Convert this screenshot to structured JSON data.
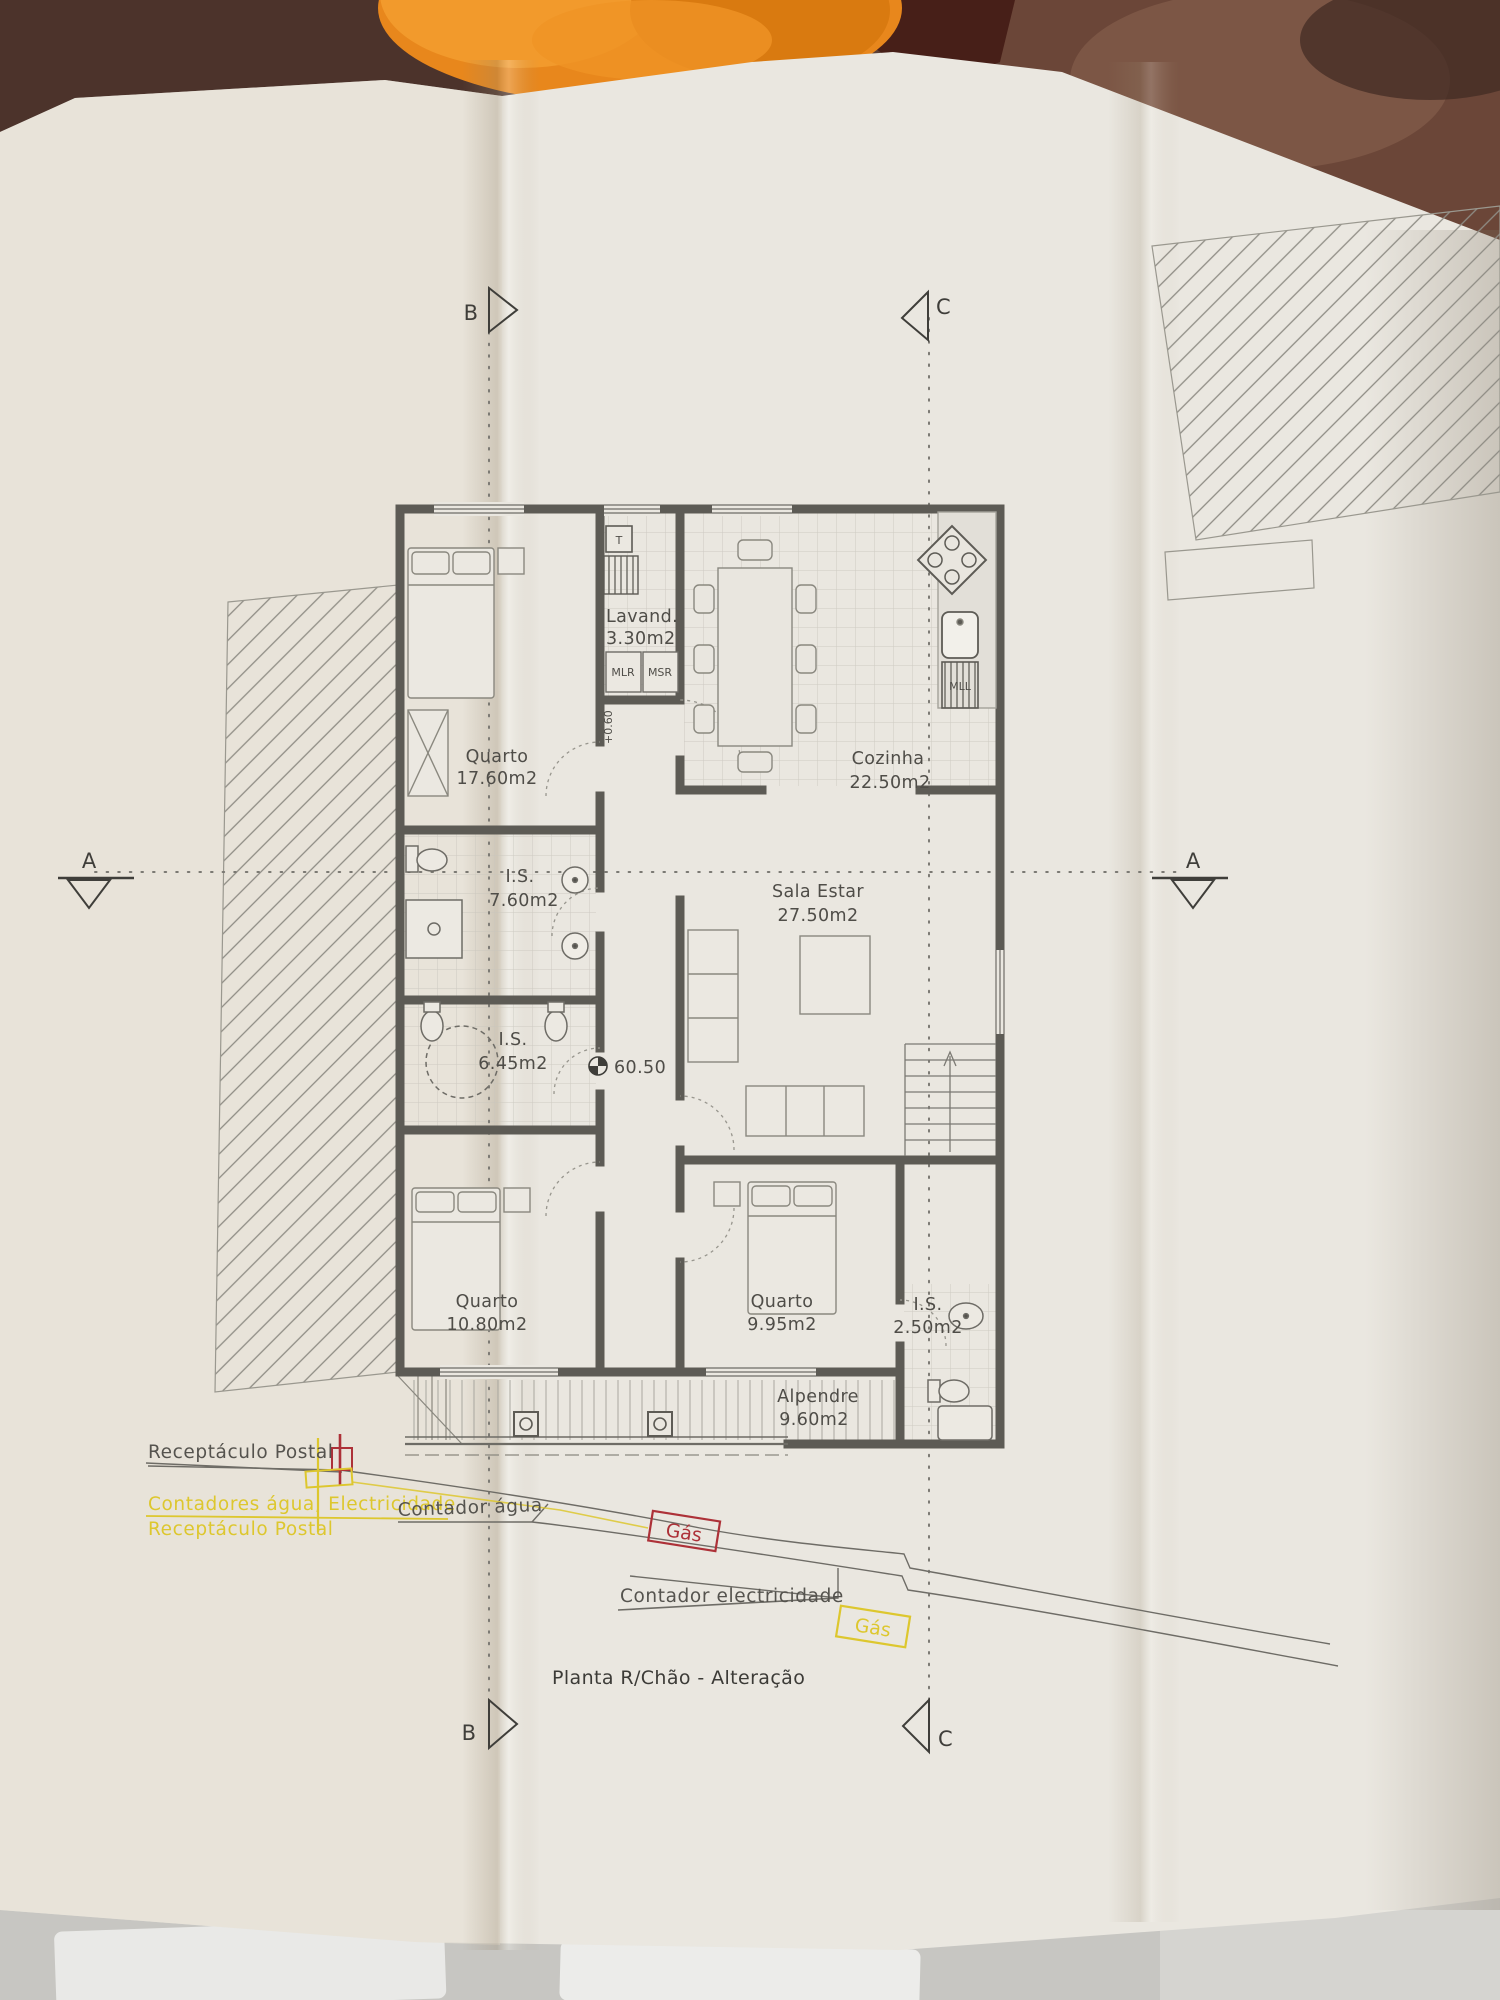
{
  "title": "Planta R/Chão - Alteração",
  "section_markers": {
    "a": "A",
    "b": "B",
    "c": "C"
  },
  "rooms": [
    {
      "name": "Quarto",
      "area": "17.60m2"
    },
    {
      "name": "Lavand.",
      "area": "3.30m2"
    },
    {
      "name": "Cozinha",
      "area": "22.50m2"
    },
    {
      "name": "I.S.",
      "area": "7.60m2"
    },
    {
      "name": "Sala  Estar",
      "area": "27.50m2"
    },
    {
      "name": "I.S.",
      "area": "6.45m2"
    },
    {
      "name": "Quarto",
      "area": "10.80m2"
    },
    {
      "name": "Quarto",
      "area": "9.95m2"
    },
    {
      "name": "I.S.",
      "area": "2.50m2"
    },
    {
      "name": "Alpendre",
      "area": "9.60m2"
    }
  ],
  "levels": {
    "floor_level": "60.50",
    "step_level": "+0.60"
  },
  "appliances": {
    "t": "T",
    "mlr": "MLR",
    "msr": "MSR",
    "mll": "MLL"
  },
  "annotations": {
    "receptaculo_postal": "Receptáculo Postal",
    "contadores": "Contadores água; Electricidade",
    "receptaculo_postal_2": "Receptáculo Postal",
    "contador_agua": "Contador água",
    "gas_1": "Gás",
    "contador_electricidade": "Contador electricidade",
    "gas_2": "Gás"
  },
  "colors": {
    "annotation_yellow": "#ddc72e",
    "annotation_red": "#ad3138",
    "drawing_gray": "#55534e",
    "paper": "#eae7e0",
    "cloth_orange": "#e8871c",
    "background_brown": "#5c4036"
  }
}
